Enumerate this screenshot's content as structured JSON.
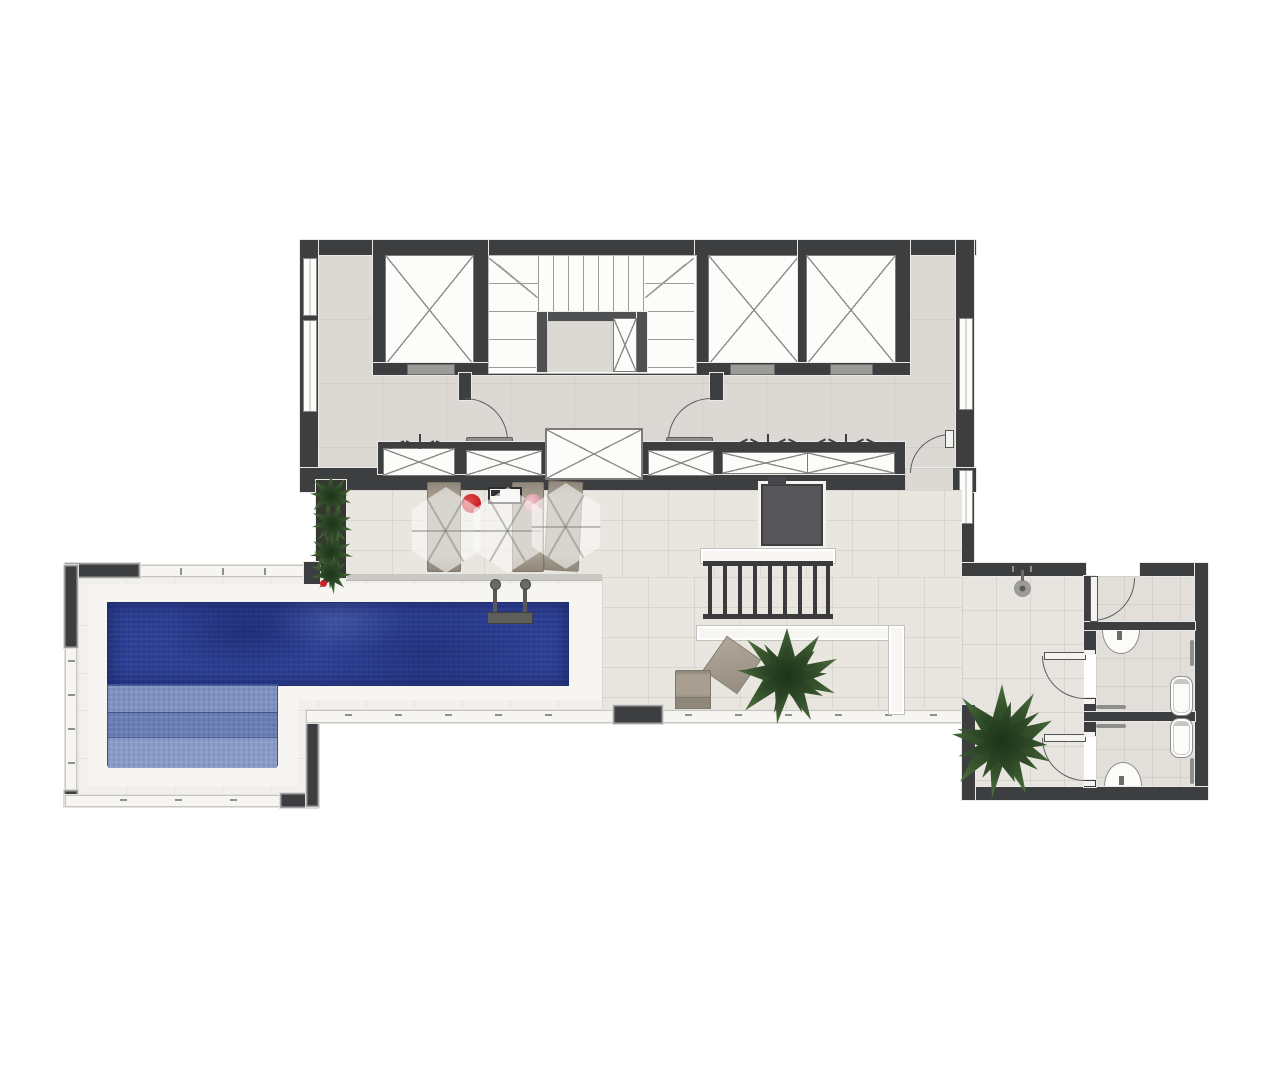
{
  "meta": {
    "title": "Rooftop pool terrace architectural floor plan (top-down rendered view)",
    "image_width_px": 1280,
    "image_height_px": 1066,
    "visible_text": "none — the drawing contains no labels, dimensions or annotations"
  },
  "colors": {
    "wall": "#3d3e40",
    "wall-mid": "#4f5052",
    "floor-core": "#dcd9d4",
    "floor-strip": "#e9e5df",
    "floor-deck": "#f1f0ec",
    "floor-corridor": "#e8e5e0",
    "floor-room": "#e2dfda",
    "fixture-white": "#fcfcfb",
    "coping-white": "#f6f5f1",
    "pool-deep": "#2c3f94",
    "pool-step-1": "#8092c2",
    "pool-step-2": "#6a7eb4",
    "pool-step-3": "#8c9cc8",
    "furniture-tan": "#a89f92",
    "furniture-tan-dark": "#8f8779",
    "accent-red": "#cd2027",
    "accent-pink": "#dc9aa5",
    "plant-dark": "#274421",
    "plant-mid": "#3f5f33",
    "plant-light": "#567d45",
    "metal": "#989896",
    "line": "#8a8a88"
  },
  "legend": {
    "core": "Building core with three elevator shafts, main stair and service closets",
    "elevator": "Elevator shaft (X marks the shaft void)",
    "stair": "Main stair with U-landing and small service shaft",
    "closets": "Built-in closets and shafts with bi-fold doors along the hall",
    "hall": "Elevator lobby / hall",
    "terrace": "Open-air leisure terrace with stone paving",
    "pool": "L-shaped swimming pool with shallow entry steps",
    "pool_ladder": "Pool ladder",
    "sun_loungers": "Sun loungers with translucent parasols and round side tables",
    "barbecue": "Barbecue / grill counter",
    "spa": "Spa / service hatch (dark square)",
    "pergola": "Slatted pergola over built-in white benches",
    "planter": "Linear planter with shrubs against the core wall",
    "restrooms": "Restroom block: vestibule, storage room and two accessible washrooms",
    "washroom": "Accessible washroom with wall-hung basin, toilet and grab bars",
    "outdoor_shower": "Outdoor pool shower",
    "parapet": "Terrace parapet / glass guard rail",
    "lounge_corner": "Lounge corner with ottoman, low chair and potted plants"
  },
  "counts": {
    "elevators": 3,
    "parasols": 3,
    "sun_loungers": 3,
    "closet_bays": 6,
    "washrooms": 2,
    "toilets": 2,
    "basins": 2,
    "free_standing_plants": 2,
    "door_swings": 8
  }
}
